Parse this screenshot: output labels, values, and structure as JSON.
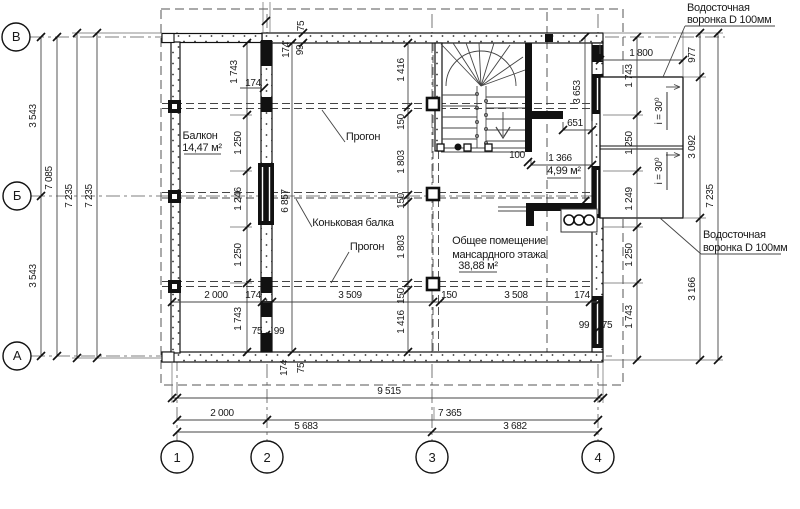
{
  "meta": {
    "type": "План мансардного этажа",
    "language": "ru",
    "line_color": "#1a1a1a",
    "background": "#ffffff"
  },
  "axes": {
    "horizontal_letters": [
      "В",
      "Б",
      "А"
    ],
    "vertical_numbers": [
      "1",
      "2",
      "3",
      "4"
    ]
  },
  "rooms": [
    {
      "name": "Балкон",
      "area": "14,47 м²"
    },
    {
      "name": "Общее помещение мансардного этажа",
      "area": "38,88 м²"
    },
    {
      "name": "Лестничный тамбур",
      "area": "4,99 м²"
    }
  ],
  "notes": {
    "drain_top": "Водосточная воронка D 100мм",
    "drain_bottom": "Водосточная воронка D 100мм",
    "ridge_beam": "Коньковая балка",
    "purlin": "Прогон",
    "slope": "i = 30⁰"
  },
  "overall_dimensions": {
    "bottom": [
      "9 515",
      "2 000",
      "7 365",
      "5 683",
      "3 682"
    ],
    "left": [
      "3 543",
      "3 543",
      "7 085",
      "7 235",
      "7 235"
    ],
    "right": [
      "977",
      "3 092",
      "3 166",
      "7 235",
      "1 800"
    ]
  },
  "texts": [
    {
      "n": "axis-letter-v",
      "t": "В",
      "x": 16,
      "y": 41,
      "a": "m",
      "fs": 13
    },
    {
      "n": "axis-letter-b",
      "t": "Б",
      "x": 17,
      "y": 200,
      "a": "m",
      "fs": 13
    },
    {
      "n": "axis-letter-a",
      "t": "А",
      "x": 17,
      "y": 360,
      "a": "m",
      "fs": 13
    },
    {
      "n": "axis-number-1",
      "t": "1",
      "x": 177,
      "y": 462,
      "a": "m",
      "fs": 13
    },
    {
      "n": "axis-number-2",
      "t": "2",
      "x": 267,
      "y": 462,
      "a": "m",
      "fs": 13
    },
    {
      "n": "axis-number-3",
      "t": "3",
      "x": 432,
      "y": 462,
      "a": "m",
      "fs": 13
    },
    {
      "n": "axis-number-4",
      "t": "4",
      "x": 598,
      "y": 462,
      "a": "m",
      "fs": 13
    },
    {
      "n": "dim",
      "t": "3 543",
      "x": 36,
      "y": 116,
      "r": -90
    },
    {
      "n": "dim",
      "t": "3 543",
      "x": 36,
      "y": 276,
      "r": -90
    },
    {
      "n": "dim",
      "t": "7 085",
      "x": 52,
      "y": 178,
      "r": -90
    },
    {
      "n": "dim",
      "t": "7 235",
      "x": 72,
      "y": 196,
      "r": -90
    },
    {
      "n": "dim",
      "t": "7 235",
      "x": 92,
      "y": 196,
      "r": -90
    },
    {
      "n": "dim",
      "t": "1 743",
      "x": 632,
      "y": 76,
      "r": -90
    },
    {
      "n": "dim",
      "t": "1 250",
      "x": 632,
      "y": 143,
      "r": -90
    },
    {
      "n": "dim",
      "t": "1 249",
      "x": 632,
      "y": 199,
      "r": -90
    },
    {
      "n": "dim",
      "t": "1 250",
      "x": 632,
      "y": 255,
      "r": -90
    },
    {
      "n": "dim",
      "t": "1 743",
      "x": 632,
      "y": 317,
      "r": -90
    },
    {
      "n": "dim",
      "t": "977",
      "x": 695,
      "y": 55,
      "r": -90
    },
    {
      "n": "dim",
      "t": "3 092",
      "x": 695,
      "y": 147,
      "r": -90
    },
    {
      "n": "dim",
      "t": "3 166",
      "x": 695,
      "y": 289,
      "r": -90
    },
    {
      "n": "dim",
      "t": "7 235",
      "x": 713,
      "y": 196,
      "r": -90
    },
    {
      "n": "dim",
      "t": "1 800",
      "x": 641,
      "y": 56,
      "a": "m"
    },
    {
      "n": "dim",
      "t": "3 653",
      "x": 580,
      "y": 92,
      "r": -90
    },
    {
      "n": "dim",
      "t": "75",
      "x": 304,
      "y": 26,
      "r": -90
    },
    {
      "n": "dim",
      "t": "99",
      "x": 303,
      "y": 50,
      "r": -90
    },
    {
      "n": "dim",
      "t": "174",
      "x": 289,
      "y": 50,
      "r": -90
    },
    {
      "n": "dim",
      "t": "1 743",
      "x": 237,
      "y": 72,
      "r": -90
    },
    {
      "n": "dim",
      "t": "174",
      "x": 253,
      "y": 86,
      "a": "m"
    },
    {
      "n": "dim",
      "t": "1 250",
      "x": 241,
      "y": 143,
      "r": -90
    },
    {
      "n": "dim",
      "t": "1 246",
      "x": 241,
      "y": 199,
      "r": -90
    },
    {
      "n": "dim",
      "t": "1 250",
      "x": 241,
      "y": 255,
      "r": -90
    },
    {
      "n": "dim",
      "t": "1 743",
      "x": 241,
      "y": 319,
      "r": -90
    },
    {
      "n": "dim",
      "t": "1 416",
      "x": 404,
      "y": 70,
      "r": -90
    },
    {
      "n": "dim",
      "t": "150",
      "x": 404,
      "y": 122,
      "r": -90
    },
    {
      "n": "dim",
      "t": "1 803",
      "x": 404,
      "y": 162,
      "r": -90
    },
    {
      "n": "dim",
      "t": "150",
      "x": 404,
      "y": 201,
      "r": -90
    },
    {
      "n": "dim",
      "t": "1 803",
      "x": 404,
      "y": 247,
      "r": -90
    },
    {
      "n": "dim",
      "t": "150",
      "x": 404,
      "y": 296,
      "r": -90
    },
    {
      "n": "dim",
      "t": "1 416",
      "x": 404,
      "y": 322,
      "r": -90
    },
    {
      "n": "dim",
      "t": "6 857",
      "x": 288,
      "y": 201,
      "r": -90
    },
    {
      "n": "dim",
      "t": "2 000",
      "x": 216,
      "y": 298,
      "a": "m"
    },
    {
      "n": "dim",
      "t": "174",
      "x": 253,
      "y": 298,
      "a": "m"
    },
    {
      "n": "dim",
      "t": "3 509",
      "x": 350,
      "y": 298,
      "a": "m"
    },
    {
      "n": "dim",
      "t": "150",
      "x": 449,
      "y": 298,
      "a": "m"
    },
    {
      "n": "dim",
      "t": "3 508",
      "x": 516,
      "y": 298,
      "a": "m"
    },
    {
      "n": "dim",
      "t": "174",
      "x": 582,
      "y": 298,
      "a": "m"
    },
    {
      "n": "dim",
      "t": "75",
      "x": 257,
      "y": 334,
      "a": "m"
    },
    {
      "n": "dim",
      "t": "99",
      "x": 279,
      "y": 334,
      "a": "m"
    },
    {
      "n": "dim",
      "t": "174",
      "x": 287,
      "y": 368,
      "r": -90
    },
    {
      "n": "dim",
      "t": "75",
      "x": 304,
      "y": 368,
      "r": -90
    },
    {
      "n": "dim",
      "t": "99",
      "x": 584,
      "y": 328,
      "a": "m"
    },
    {
      "n": "dim",
      "t": "75",
      "x": 607,
      "y": 328,
      "a": "m"
    },
    {
      "n": "dim",
      "t": "651",
      "x": 575,
      "y": 126,
      "a": "m"
    },
    {
      "n": "dim",
      "t": "1 366",
      "x": 560,
      "y": 161,
      "a": "m"
    },
    {
      "n": "dim",
      "t": "100",
      "x": 517,
      "y": 158,
      "a": "m"
    },
    {
      "n": "room-area",
      "t": "4,99 м²",
      "x": 564,
      "y": 174,
      "a": "m",
      "fs": 11
    },
    {
      "n": "room-name",
      "t": "Балкон",
      "x": 200,
      "y": 139,
      "a": "m",
      "fs": 11
    },
    {
      "n": "room-area",
      "t": "14,47 м²",
      "x": 202,
      "y": 151,
      "a": "m",
      "fs": 11
    },
    {
      "n": "note-purlin",
      "t": "Прогон",
      "x": 363,
      "y": 140,
      "a": "m",
      "fs": 11
    },
    {
      "n": "note-ridge-beam",
      "t": "Коньковая балка",
      "x": 353,
      "y": 226,
      "a": "m",
      "fs": 11
    },
    {
      "n": "note-purlin",
      "t": "Прогон",
      "x": 367,
      "y": 250,
      "a": "m",
      "fs": 11
    },
    {
      "n": "room-name",
      "t": "Общее помещение",
      "x": 499,
      "y": 244,
      "a": "m",
      "fs": 11
    },
    {
      "n": "room-name",
      "t": "мансардного этажа",
      "x": 499,
      "y": 258,
      "a": "m",
      "fs": 11
    },
    {
      "n": "room-area",
      "t": "38,88 м²",
      "x": 478,
      "y": 269,
      "a": "m",
      "fs": 11
    },
    {
      "n": "note-drain",
      "t": "Водосточная",
      "x": 687,
      "y": 11,
      "a": "s",
      "fs": 11
    },
    {
      "n": "note-drain",
      "t": "воронка D 100мм",
      "x": 687,
      "y": 23,
      "a": "s",
      "fs": 11
    },
    {
      "n": "note-drain",
      "t": "Водосточная",
      "x": 703,
      "y": 238,
      "a": "s",
      "fs": 11
    },
    {
      "n": "note-drain",
      "t": "воронка D 100мм",
      "x": 703,
      "y": 251,
      "a": "s",
      "fs": 11
    },
    {
      "n": "note-slope",
      "t": "i = 30⁰",
      "x": 662,
      "y": 111,
      "r": -90
    },
    {
      "n": "note-slope",
      "t": "i = 30⁰",
      "x": 662,
      "y": 171,
      "r": -90
    },
    {
      "n": "dim",
      "t": "9 515",
      "x": 389,
      "y": 394,
      "a": "m"
    },
    {
      "n": "dim",
      "t": "2 000",
      "x": 222,
      "y": 416,
      "a": "m"
    },
    {
      "n": "dim",
      "t": "7 365",
      "x": 438,
      "y": 416,
      "a": "s"
    },
    {
      "n": "dim",
      "t": "5 683",
      "x": 306,
      "y": 429,
      "a": "m"
    },
    {
      "n": "dim",
      "t": "3 682",
      "x": 515,
      "y": 429,
      "a": "m"
    }
  ],
  "ticks": [
    [
      41,
      37
    ],
    [
      41,
      196
    ],
    [
      41,
      356
    ],
    [
      57,
      37
    ],
    [
      57,
      356
    ],
    [
      77,
      33
    ],
    [
      77,
      358
    ],
    [
      97,
      33
    ],
    [
      97,
      358
    ],
    [
      637,
      37
    ],
    [
      637,
      115
    ],
    [
      637,
      171
    ],
    [
      637,
      227
    ],
    [
      637,
      283
    ],
    [
      637,
      360
    ],
    [
      700,
      33
    ],
    [
      700,
      77
    ],
    [
      700,
      218
    ],
    [
      700,
      360
    ],
    [
      718,
      33
    ],
    [
      718,
      360
    ],
    [
      600,
      60
    ],
    [
      683,
      60
    ],
    [
      585,
      37
    ],
    [
      585,
      201
    ],
    [
      247,
      43
    ],
    [
      247,
      115
    ],
    [
      247,
      171
    ],
    [
      247,
      227
    ],
    [
      247,
      283
    ],
    [
      247,
      352
    ],
    [
      408,
      43
    ],
    [
      408,
      107
    ],
    [
      408,
      114
    ],
    [
      408,
      195
    ],
    [
      408,
      202
    ],
    [
      408,
      283
    ],
    [
      408,
      290
    ],
    [
      408,
      352
    ],
    [
      292,
      43
    ],
    [
      292,
      352
    ],
    [
      172,
      302
    ],
    [
      262,
      302
    ],
    [
      272,
      302
    ],
    [
      433,
      302
    ],
    [
      440,
      302
    ],
    [
      590,
      302
    ],
    [
      598,
      302
    ],
    [
      563,
      130
    ],
    [
      592,
      130
    ],
    [
      531,
      165
    ],
    [
      592,
      165
    ],
    [
      172,
      398
    ],
    [
      177,
      398
    ],
    [
      598,
      398
    ],
    [
      603,
      398
    ],
    [
      177,
      420
    ],
    [
      267,
      420
    ],
    [
      598,
      420
    ],
    [
      177,
      432
    ],
    [
      432,
      432
    ],
    [
      598,
      432
    ],
    [
      303,
      33
    ],
    [
      303,
      43
    ],
    [
      264,
      88
    ],
    [
      266,
      335
    ],
    [
      596,
      331
    ],
    [
      528,
      162
    ],
    [
      266,
      21
    ]
  ]
}
